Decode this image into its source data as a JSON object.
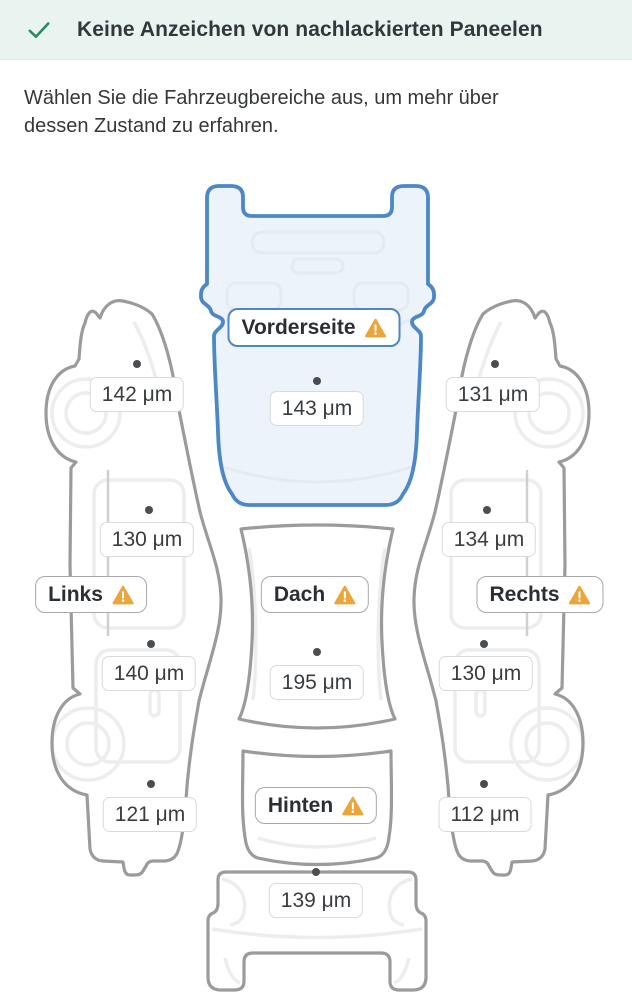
{
  "banner": {
    "icon": "check-icon",
    "text": "Keine Anzeichen von nachlackierten Paneelen"
  },
  "intro": {
    "text": "Wählen Sie die Fahrzeugbereiche aus, um mehr über dessen Zustand zu erfahren."
  },
  "diagram": {
    "unit": "μm",
    "sections": {
      "front": {
        "label": "Vorderseite",
        "warning": true,
        "selected": true,
        "measurement": "143 μm"
      },
      "left": {
        "label": "Links",
        "warning": true,
        "selected": false,
        "measurements": [
          "142 μm",
          "130 μm",
          "140 μm",
          "121 μm"
        ]
      },
      "right": {
        "label": "Rechts",
        "warning": true,
        "selected": false,
        "measurements": [
          "131 μm",
          "134 μm",
          "130 μm",
          "112 μm"
        ]
      },
      "roof": {
        "label": "Dach",
        "warning": true,
        "selected": false,
        "measurement": "195 μm"
      },
      "rear": {
        "label": "Hinten",
        "warning": true,
        "selected": false,
        "measurement": "139 μm"
      }
    },
    "colors": {
      "selected_stroke": "#4C87C6",
      "selected_fill": "#EDF3FA",
      "outline": "#9B9B9B",
      "detail_line": "#ECEDEE",
      "warning": "#E9A63A",
      "check_green": "#2B8A61",
      "banner_bg": "#E9F3EF"
    }
  }
}
